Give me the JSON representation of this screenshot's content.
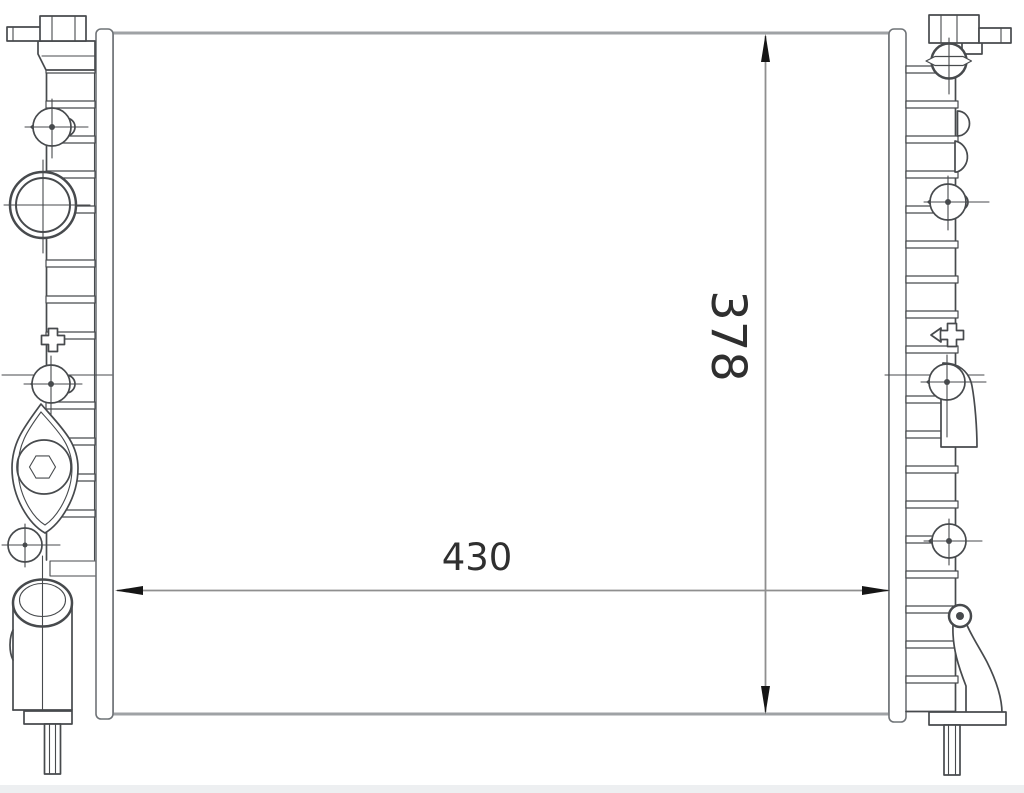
{
  "dimensions": {
    "width_label": "430",
    "height_label": "378"
  },
  "colors": {
    "background": "#ffffff",
    "part_line": "#474a4d",
    "edge_line": "#9fa2a5",
    "strip_line": "#6f7377",
    "dimension_line": "#8f8f8f",
    "arrow": "#161616",
    "text": "#2f2f2f",
    "bottom_strip": "#edeff1"
  }
}
